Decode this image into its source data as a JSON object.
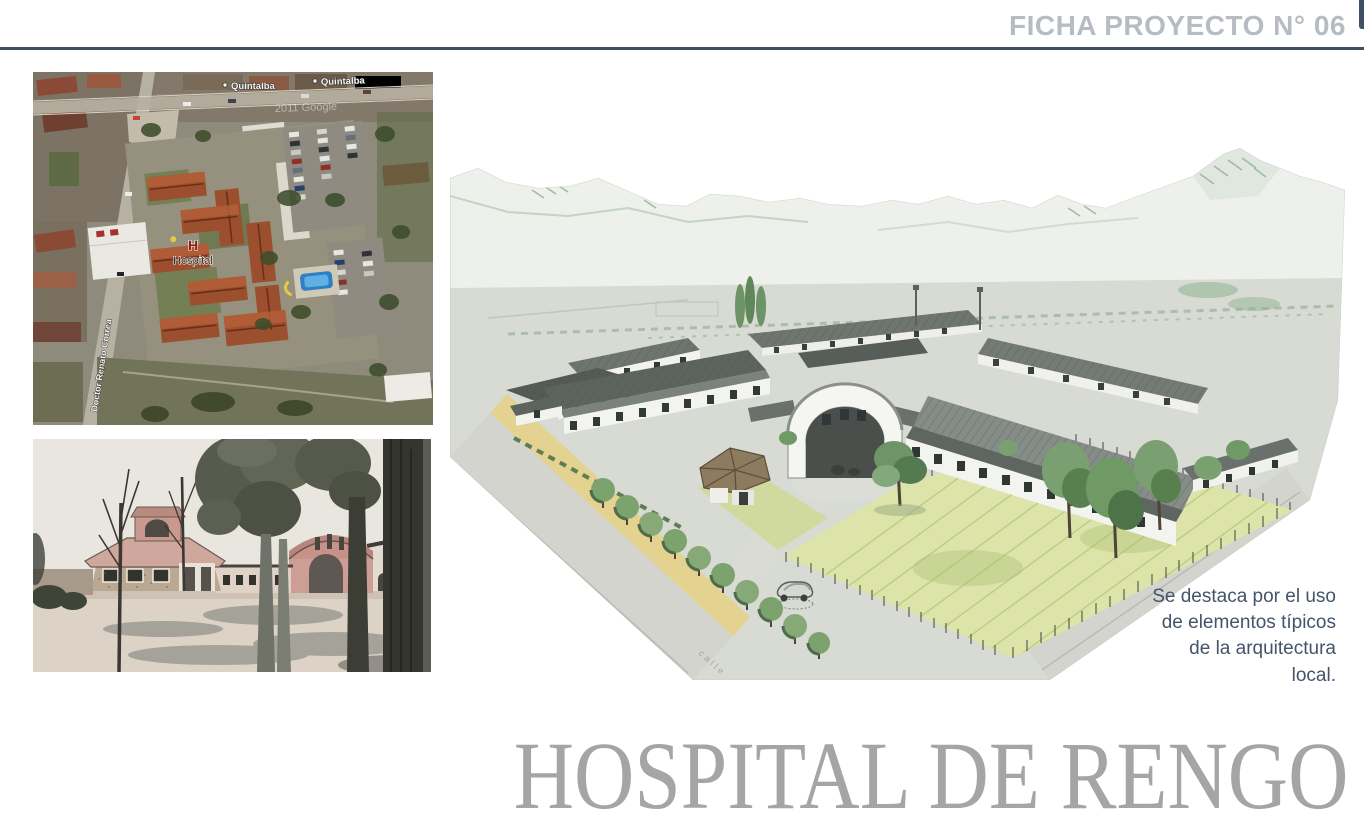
{
  "header": {
    "title": "FICHA PROYECTO N° 06"
  },
  "satellite_map": {
    "street_label_top_left": "Quintalba",
    "street_label_top_right": "Quintalba",
    "hospital_marker_letter": "H",
    "hospital_marker_label": "Hospital",
    "street_label_left": "Doctor Renato Correa",
    "watermark": "2011 Google"
  },
  "sketch": {
    "road_label": "calle"
  },
  "caption": {
    "text": "Se destaca por el uso de elementos típicos de la arquitectura local."
  },
  "footer": {
    "title": "HOSPITAL DE RENGO"
  },
  "colors": {
    "rule_accent": "#3D5066",
    "header_text": "#B7BCC2",
    "caption_text": "#44546A",
    "footer_title_text": "#A5A5A5"
  }
}
